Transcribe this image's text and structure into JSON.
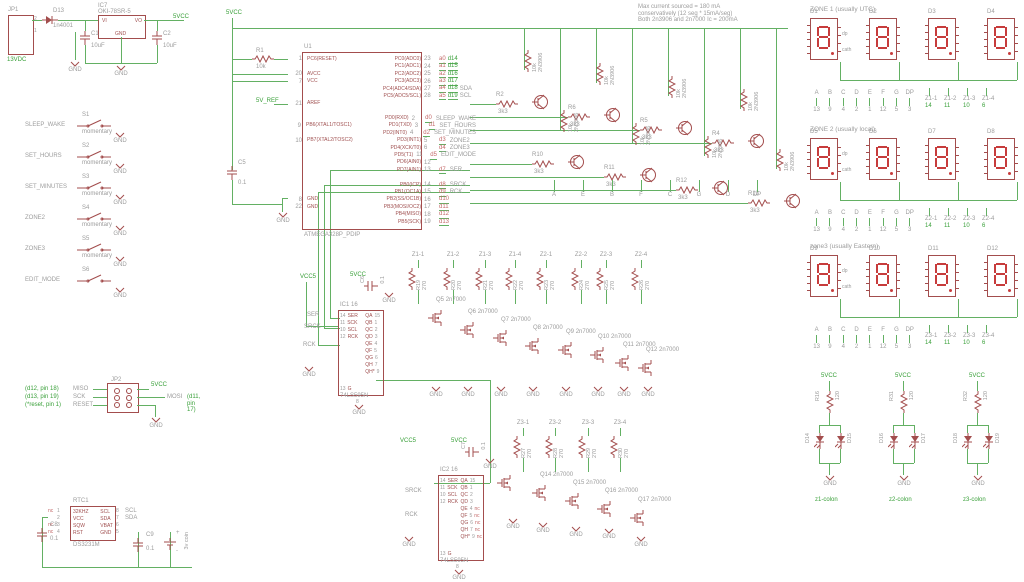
{
  "power": {
    "jp1_name": "JP1",
    "jp1_pin_top": "2",
    "jp1_pin_bot": "1",
    "input_net": "13VDC",
    "gnd": "GND",
    "d13_name": "D13",
    "d13_value": "1n4001",
    "ic7_name": "IC7",
    "ic7_value": "OKI-78SR-5",
    "ic7_vi": "VI",
    "ic7_vo": "VO",
    "ic7_gnd": "GND",
    "c1_name": "C1",
    "c1_value": "10uF",
    "c2_name": "C2",
    "c2_value": "10uF",
    "output_net": "5VCC"
  },
  "switches": {
    "items": [
      {
        "net": "SLEEP_WAKE",
        "name": "S1",
        "type": "momentary",
        "gnd": "GND"
      },
      {
        "net": "SET_HOURS",
        "name": "S2",
        "type": "momentary",
        "gnd": "GND"
      },
      {
        "net": "SET_MINUTES",
        "name": "S3",
        "type": "momentary",
        "gnd": "GND"
      },
      {
        "net": "ZONE2",
        "name": "S4",
        "type": "momentary",
        "gnd": "GND"
      },
      {
        "net": "ZONE3",
        "name": "S5",
        "type": "momentary",
        "gnd": "GND"
      },
      {
        "net": "EDIT_MODE",
        "name": "S6",
        "type": "",
        "gnd": "GND"
      }
    ]
  },
  "notes": {
    "lines": [
      "Max current sourced = 180 mA",
      "conservatively (12 seg * 15mA/seg)",
      "Both 2n3906 and 2n7000 Ic = 200mA"
    ]
  },
  "mcu": {
    "name": "U1",
    "value": "ATMEGA328P_PDIP",
    "vcc_net": "5VCC",
    "aref_net": "5V_REF",
    "gnd": "GND",
    "r1_name": "R1",
    "r1_value": "10k",
    "c5_name": "C5",
    "c5_value": "0.1",
    "rows": [
      {
        "ln": "1",
        "ll": "PC6(RESET)",
        "rn": "23",
        "rl": "PC0(ADC0)",
        "n1": "a0",
        "n2": "d14",
        "sig": ""
      },
      {
        "ln": "",
        "ll": "",
        "rn": "24",
        "rl": "PC1(ADC1)",
        "n1": "a1",
        "n2": "d15",
        "sig": ""
      },
      {
        "ln": "20",
        "ll": "AVCC",
        "rn": "25",
        "rl": "PC2(ADC2)",
        "n1": "a2",
        "n2": "d16",
        "sig": ""
      },
      {
        "ln": "7",
        "ll": "VCC",
        "rn": "26",
        "rl": "PC3(ADC3)",
        "n1": "a3",
        "n2": "d17",
        "sig": ""
      },
      {
        "ln": "",
        "ll": "",
        "rn": "27",
        "rl": "PC4(ADC4/SDA)",
        "n1": "a4",
        "n2": "d18",
        "sig": "SDA"
      },
      {
        "ln": "",
        "ll": "",
        "rn": "28",
        "rl": "PC5(ADC5/SCL)",
        "n1": "a5",
        "n2": "d19",
        "sig": "SCL"
      },
      {
        "ln": "21",
        "ll": "AREF",
        "rn": "",
        "rl": "",
        "n1": "",
        "n2": "",
        "sig": ""
      },
      {
        "ln": "",
        "ll": "",
        "rn": "",
        "rl": "",
        "n1": "",
        "n2": "",
        "sig": ""
      },
      {
        "ln": "",
        "ll": "",
        "rn": "2",
        "rl": "PD0(RXD)",
        "n1": "d0",
        "n2": "",
        "sig": "SLEEP_WAKE"
      },
      {
        "ln": "9",
        "ll": "PB6(XTAL1/TOSC1)",
        "rn": "3",
        "rl": "PD1(TXD)",
        "n1": "d1",
        "n2": "",
        "sig": "SET_HOURS"
      },
      {
        "ln": "",
        "ll": "",
        "rn": "4",
        "rl": "PD2(INT0)",
        "n1": "d2",
        "n2": "",
        "sig": "SET_MINUTES"
      },
      {
        "ln": "10",
        "ll": "PB7(XTAL2/TOSC2)",
        "rn": "5",
        "rl": "PD3(INT1)",
        "n1": "d3",
        "n2": "",
        "sig": "ZONE2"
      },
      {
        "ln": "",
        "ll": "",
        "rn": "6",
        "rl": "PD4(XCK/T0)",
        "n1": "d4",
        "n2": "",
        "sig": "ZONE3"
      },
      {
        "ln": "",
        "ll": "",
        "rn": "11",
        "rl": "PD5(T1)",
        "n1": "d5",
        "n2": "",
        "sig": "EDIT_MODE"
      },
      {
        "ln": "",
        "ll": "",
        "rn": "12",
        "rl": "PD6(AIN0)",
        "n1": "",
        "n2": "",
        "sig": ""
      },
      {
        "ln": "",
        "ll": "",
        "rn": "13",
        "rl": "PD7(AIN1)",
        "n1": "d7",
        "n2": "",
        "sig": "SER"
      },
      {
        "ln": "",
        "ll": "",
        "rn": "",
        "rl": "",
        "n1": "",
        "n2": "",
        "sig": ""
      },
      {
        "ln": "",
        "ll": "",
        "rn": "14",
        "rl": "PB0(ICP)",
        "n1": "d8",
        "n2": "",
        "sig": "SRCK"
      },
      {
        "ln": "",
        "ll": "",
        "rn": "15",
        "rl": "PB1(OC1A)",
        "n1": "d9",
        "n2": "",
        "sig": "RCK"
      },
      {
        "ln": "8",
        "ll": "GND",
        "rn": "16",
        "rl": "PB2(SS/OC1B)",
        "n1": "d10",
        "n2": "",
        "sig": ""
      },
      {
        "ln": "22",
        "ll": "GND",
        "rn": "17",
        "rl": "PB3(MOSI/OC2)",
        "n1": "d11",
        "n2": "",
        "sig": ""
      },
      {
        "ln": "",
        "ll": "",
        "rn": "18",
        "rl": "PB4(MISO)",
        "n1": "d12",
        "n2": "",
        "sig": ""
      },
      {
        "ln": "",
        "ll": "",
        "rn": "19",
        "rl": "PB5(SCK)",
        "n1": "d13",
        "n2": "",
        "sig": ""
      }
    ]
  },
  "drivers": {
    "row1": [
      {
        "r": "R2",
        "rv": "3k3",
        "pull": "10k",
        "qv": "2N3906"
      },
      {
        "r": "R6",
        "rv": "3k3",
        "pull": "10k",
        "qv": "2N3906"
      },
      {
        "r": "R5",
        "rv": "3k3",
        "pull": "10k",
        "qv": "2N3906"
      },
      {
        "r": "R4",
        "rv": "3k3",
        "pull": "10k",
        "qv": "2N3906"
      }
    ],
    "row2": [
      {
        "r": "R10",
        "rv": "3k3",
        "pull": "10k",
        "qv": "2N3906"
      },
      {
        "r": "R11",
        "rv": "3k3",
        "pull": "10k",
        "qv": "2N3906"
      },
      {
        "r": "R12",
        "rv": "3k3",
        "pull": "10k",
        "qv": "2N3906"
      },
      {
        "r": "R13",
        "rv": "3k3",
        "pull": "10k",
        "qv": "2N3906"
      }
    ],
    "segments": [
      "A",
      "E",
      "B",
      "F",
      "C",
      "G",
      "D",
      "DP"
    ]
  },
  "zones": [
    {
      "title": "ZONE 1 (usually UTC)",
      "displays": [
        "D1",
        "D2",
        "D3",
        "D4"
      ],
      "dp_label": "dp",
      "cath_label": "cath",
      "segtable": [
        {
          "l": "A",
          "p": "13"
        },
        {
          "l": "B",
          "p": "9"
        },
        {
          "l": "C",
          "p": "4"
        },
        {
          "l": "D",
          "p": "2"
        },
        {
          "l": "E",
          "p": "1"
        },
        {
          "l": "F",
          "p": "12"
        },
        {
          "l": "G",
          "p": "5"
        },
        {
          "l": "DP",
          "p": "3"
        }
      ],
      "digits": [
        {
          "net": "Z1-1",
          "pin": "14"
        },
        {
          "net": "Z1-2",
          "pin": "11"
        },
        {
          "net": "Z1-3",
          "pin": "10"
        },
        {
          "net": "Z1-4",
          "pin": "6"
        }
      ]
    },
    {
      "title": "ZONE 2 (usually local)",
      "displays": [
        "D5",
        "D6",
        "D7",
        "D8"
      ],
      "dp_label": "dp",
      "cath_label": "cath",
      "segtable": [
        {
          "l": "A",
          "p": "13"
        },
        {
          "l": "B",
          "p": "9"
        },
        {
          "l": "C",
          "p": "4"
        },
        {
          "l": "D",
          "p": "2"
        },
        {
          "l": "E",
          "p": "1"
        },
        {
          "l": "F",
          "p": "12"
        },
        {
          "l": "G",
          "p": "5"
        },
        {
          "l": "DP",
          "p": "3"
        }
      ],
      "digits": [
        {
          "net": "Z2-1",
          "pin": "14"
        },
        {
          "net": "Z2-2",
          "pin": "11"
        },
        {
          "net": "Z2-3",
          "pin": "10"
        },
        {
          "net": "Z2-4",
          "pin": "6"
        }
      ]
    },
    {
      "title": "zone3 (usually Eastern)",
      "displays": [
        "D9",
        "D10",
        "D11",
        "D12"
      ],
      "dp_label": "dp",
      "cath_label": "cath",
      "segtable": [
        {
          "l": "A",
          "p": "13"
        },
        {
          "l": "B",
          "p": "9"
        },
        {
          "l": "C",
          "p": "4"
        },
        {
          "l": "D",
          "p": "2"
        },
        {
          "l": "E",
          "p": "1"
        },
        {
          "l": "F",
          "p": "12"
        },
        {
          "l": "G",
          "p": "5"
        },
        {
          "l": "DP",
          "p": "3"
        }
      ],
      "digits": [
        {
          "net": "Z3-1",
          "pin": "14"
        },
        {
          "net": "Z3-2",
          "pin": "11"
        },
        {
          "net": "Z3-3",
          "pin": "10"
        },
        {
          "net": "Z3-4",
          "pin": "6"
        }
      ]
    }
  ],
  "shift1": {
    "name": "IC1",
    "vcc_pin": "16",
    "value": "74LS595N",
    "gnd_pin": "8",
    "vcc5_net": "VCC5",
    "vcc_net": "5VCC",
    "cap_name": "C6",
    "cap_value": "0.1",
    "gnd": "GND",
    "ser_net": "SER",
    "srck_net": "SRCK",
    "rck_net": "RCK",
    "left_pins": [
      {
        "num": "14",
        "label": "SER"
      },
      {
        "num": "11",
        "label": "SCK"
      },
      {
        "num": "10",
        "label": "SCL"
      },
      {
        "num": "12",
        "label": "RCK"
      },
      {
        "num": "13",
        "label": "G"
      }
    ],
    "right_pins": [
      {
        "num": "15",
        "label": "QA",
        "nc": ""
      },
      {
        "num": "1",
        "label": "QB",
        "nc": ""
      },
      {
        "num": "2",
        "label": "QC",
        "nc": ""
      },
      {
        "num": "3",
        "label": "QD",
        "nc": ""
      },
      {
        "num": "4",
        "label": "QE",
        "nc": ""
      },
      {
        "num": "5",
        "label": "QF",
        "nc": ""
      },
      {
        "num": "6",
        "label": "QG",
        "nc": ""
      },
      {
        "num": "7",
        "label": "QH",
        "nc": ""
      },
      {
        "num": "9",
        "label": "QH*",
        "nc": ""
      }
    ]
  },
  "digitrow1": {
    "gnd": "GND",
    "columns": [
      {
        "net": "Z1-1",
        "r": "R19",
        "rv": "270"
      },
      {
        "net": "Z1-2",
        "r": "R20",
        "rv": "270"
      },
      {
        "net": "Z1-3",
        "r": "R21",
        "rv": "270"
      },
      {
        "net": "Z1-4",
        "r": "R22",
        "rv": "270"
      },
      {
        "net": "Z2-1",
        "r": "R23",
        "rv": "270"
      },
      {
        "net": "Z2-2",
        "r": "R24",
        "rv": "270"
      },
      {
        "net": "Z2-3",
        "r": "R25",
        "rv": "270"
      },
      {
        "net": "Z2-4",
        "r": "R26",
        "rv": "270"
      }
    ],
    "mosfets": [
      {
        "name": "Q5",
        "value": "2n7000"
      },
      {
        "name": "Q6",
        "value": "2n7000"
      },
      {
        "name": "Q7",
        "value": "2n7000"
      },
      {
        "name": "Q8",
        "value": "2n7000"
      },
      {
        "name": "Q9",
        "value": "2n7000"
      },
      {
        "name": "Q10",
        "value": "2n7000"
      },
      {
        "name": "Q11",
        "value": "2n7000"
      },
      {
        "name": "Q12",
        "value": "2n7000"
      }
    ]
  },
  "shift2": {
    "name": "IC2",
    "vcc_pin": "16",
    "value": "74LS595N",
    "gnd_pin": "8",
    "vcc5_net": "VCC5",
    "vcc_net": "5VCC",
    "cap_name": "C7",
    "cap_value": "0.1",
    "gnd": "GND",
    "srck_net": "SRCK",
    "rck_net": "RCK",
    "left_pins": [
      {
        "num": "14",
        "label": "SER"
      },
      {
        "num": "11",
        "label": "SCK"
      },
      {
        "num": "10",
        "label": "SCL"
      },
      {
        "num": "12",
        "label": "RCK"
      },
      {
        "num": "13",
        "label": "G"
      }
    ],
    "right_pins": [
      {
        "num": "15",
        "label": "QA",
        "nc": ""
      },
      {
        "num": "1",
        "label": "QB",
        "nc": ""
      },
      {
        "num": "2",
        "label": "QC",
        "nc": ""
      },
      {
        "num": "3",
        "label": "QD",
        "nc": ""
      },
      {
        "num": "4",
        "label": "QE",
        "nc": "nc"
      },
      {
        "num": "5",
        "label": "QF",
        "nc": "nc"
      },
      {
        "num": "6",
        "label": "QG",
        "nc": "nc"
      },
      {
        "num": "7",
        "label": "QH",
        "nc": "nc"
      },
      {
        "num": "9",
        "label": "QH*",
        "nc": "nc"
      }
    ]
  },
  "digitrow2": {
    "gnd": "GND",
    "columns": [
      {
        "net": "Z3-1",
        "r": "R27",
        "rv": "270"
      },
      {
        "net": "Z3-2",
        "r": "R28",
        "rv": "270"
      },
      {
        "net": "Z3-3",
        "r": "R29",
        "rv": "270"
      },
      {
        "net": "Z3-4",
        "r": "R30",
        "rv": "270"
      }
    ],
    "mosfets": [
      {
        "name": "",
        "value": ""
      },
      {
        "name": "Q14",
        "value": "2n7000"
      },
      {
        "name": "Q15",
        "value": "2n7000"
      },
      {
        "name": "Q16",
        "value": "2n7000"
      },
      {
        "name": "Q17",
        "value": "2n7000"
      }
    ]
  },
  "isp": {
    "name": "JP2",
    "vcc_net": "5VCC",
    "gnd": "GND",
    "mosi_label": "MOSI",
    "mosi_note": "(d11, pin 17)",
    "rows": [
      {
        "note": "(d12, pin 18)",
        "label": "MISO"
      },
      {
        "note": "(d13, pin 19)",
        "label": "SCK"
      },
      {
        "note": "(*reset, pin 1)",
        "label": "RESET"
      }
    ],
    "pins_left": [
      "1",
      "3",
      "5"
    ],
    "pins_right": [
      "2",
      "4",
      "6"
    ]
  },
  "rtc": {
    "name": "RTC1",
    "value": "DS3231M",
    "left_pins": [
      {
        "num": "1",
        "nc": "nc",
        "label": "32KHZ"
      },
      {
        "num": "2",
        "nc": "",
        "label": "VCC"
      },
      {
        "num": "3",
        "nc": "nc",
        "label": "SQW"
      },
      {
        "num": "4",
        "nc": "nc",
        "label": "RST"
      }
    ],
    "right_pins": [
      {
        "num": "8",
        "label": "SCL",
        "net": "SCL"
      },
      {
        "num": "7",
        "label": "SDA",
        "net": "SDA"
      },
      {
        "num": "6",
        "label": "VBAT",
        "net": ""
      },
      {
        "num": "5",
        "label": "GND",
        "net": ""
      }
    ],
    "c8_name": "C8",
    "c8_value": "0.1",
    "c9_name": "C9",
    "c9_value": "0.1",
    "battery_value": "3v coin",
    "battery_plus": "+",
    "battery_minus": "-"
  },
  "colons": {
    "vcc_net": "5VCC",
    "gnd": "GND",
    "items": [
      {
        "r": "R16",
        "rv": "120",
        "led1": "D14",
        "led2": "D15",
        "net": "z1-colon"
      },
      {
        "r": "R31",
        "rv": "120",
        "led1": "D16",
        "led2": "D17",
        "net": "z2-colon"
      },
      {
        "r": "R32",
        "rv": "120",
        "led1": "D18",
        "led2": "D19",
        "net": "z3-colon"
      }
    ]
  }
}
